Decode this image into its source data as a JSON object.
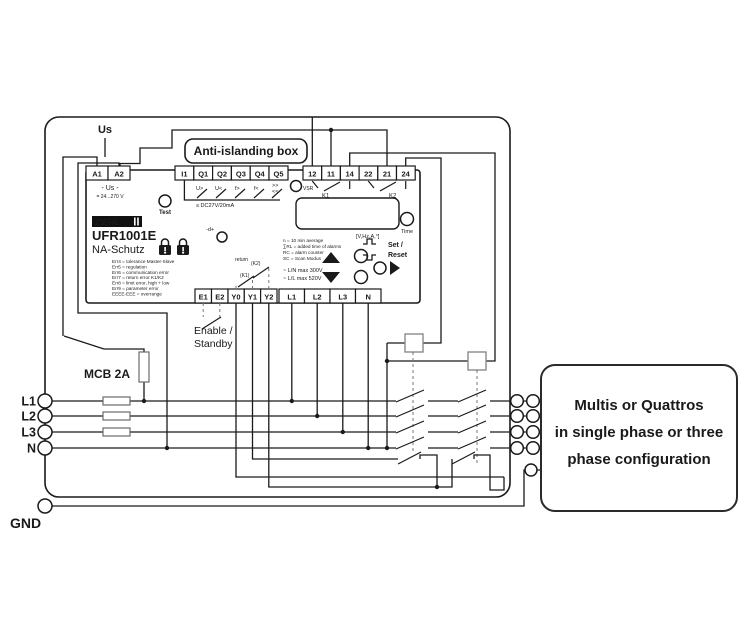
{
  "header": {
    "us_label": "Us",
    "anti_islanding_label": "Anti-islanding box"
  },
  "relay": {
    "brand": "ZIEHL",
    "model": "UFR1001E",
    "type": "NA-Schutz",
    "test_label": "Test",
    "vsr_label": "VSR",
    "time_label": "Time",
    "us_inner": "- Us -",
    "us_range": "= 24...270 V",
    "adj_label": "-d+",
    "terminals": {
      "a": [
        "A1",
        "A2"
      ],
      "q": [
        "I1",
        "Q1",
        "Q2",
        "Q3",
        "Q4",
        "Q5"
      ],
      "k": [
        "12",
        "11",
        "14",
        "22",
        "21",
        "24"
      ],
      "e": [
        "E1",
        "E2"
      ],
      "y": [
        "Y0",
        "Y1",
        "Y2"
      ],
      "l": [
        "L1",
        "L2",
        "L3",
        "N"
      ]
    },
    "q_functions": [
      "U>",
      "U<",
      "f>",
      "f<",
      ">>",
      "<<"
    ],
    "dc_note": "≤ DC27V/20mA",
    "k1_label": "K1",
    "k2_label": "K2",
    "display_units": "[V,Hz,A,°]",
    "legend": [
      "n = 10 min average",
      "∑RL = added time of alarms",
      "RC = alarm counter",
      "SC = Scan Modus"
    ],
    "errors": [
      "Err4 = tolerance Master-Slave",
      "Err5 = regulation",
      "Err6 = communication error",
      "Err7 = return error K1/K2",
      "Err8 = limit error, high + low",
      "Err9 = parameter error",
      "EEEE-EEE = overrange"
    ],
    "set_label": "Set /",
    "reset_label": "Reset",
    "max_ln": "~ L/N max 300V",
    "max_ll": "~ L/L max 520V",
    "return_label": "return",
    "return_k2": "(K2)",
    "return_k1": "(K1)"
  },
  "wiring": {
    "enable_label": "Enable /",
    "standby_label": "Standby",
    "mcb_label": "MCB 2A",
    "gnd_label": "GND",
    "phases": [
      "L1",
      "L2",
      "L3",
      "N"
    ]
  },
  "multis": {
    "line1": "Multis or Quattros",
    "line2": "in single phase or three",
    "line3": "phase  configuration"
  },
  "colors": {
    "wire": "#1a1a1a",
    "ground_green": "#3aa06a"
  }
}
